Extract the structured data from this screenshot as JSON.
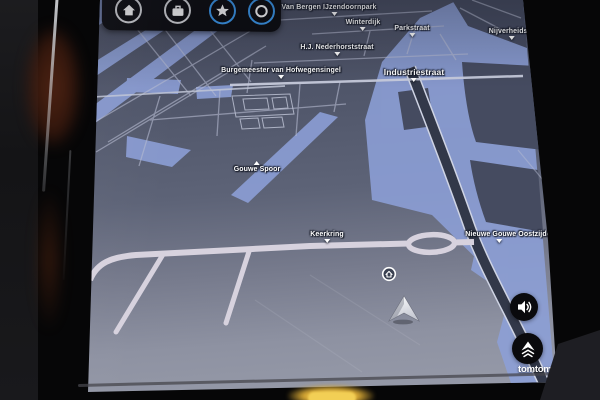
{
  "device": {
    "brand_wordmark": "tomtom"
  },
  "quick_access": {
    "buttons": [
      {
        "name": "home",
        "icon": "home-icon",
        "ring_color": "#d9dade"
      },
      {
        "name": "work",
        "icon": "briefcase-icon",
        "ring_color": "#d9dade"
      },
      {
        "name": "favorites",
        "icon": "star-icon",
        "ring_color": "#3b9af0"
      },
      {
        "name": "recent",
        "icon": "ring-icon",
        "ring_color": "#3b9af0"
      }
    ]
  },
  "map": {
    "labels": [
      "Van Bergen IJzendoornpark",
      "Winterdijk",
      "Parkstraat",
      "Nijverheidsstraat",
      "H.J. Nederhorststraat",
      "Burgemeester van Hofwegensingel",
      "Industriestraat",
      "Gouwe Spoor",
      "Keerkring",
      "Nieuwe Gouwe Oostzijde"
    ],
    "markers": [
      {
        "name": "home-destination",
        "icon": "home-badge-icon"
      },
      {
        "name": "current-position",
        "icon": "navigation-arrow-icon"
      }
    ]
  },
  "side_controls": [
    {
      "name": "volume",
      "icon": "speaker-icon"
    },
    {
      "name": "expand",
      "icon": "tomtom-arrow-icon"
    }
  ],
  "colors": {
    "map_bg_top": "#474c60",
    "map_bg_bottom": "#989caa",
    "water": "#8da0d8",
    "road_major_light": "#d7d2de",
    "road_minor": "#b6bbd1",
    "road_dark": "#323849",
    "accent_blue": "#3b9af0",
    "label_text": "#ffffff",
    "glow_yellow": "#f2cf55"
  }
}
